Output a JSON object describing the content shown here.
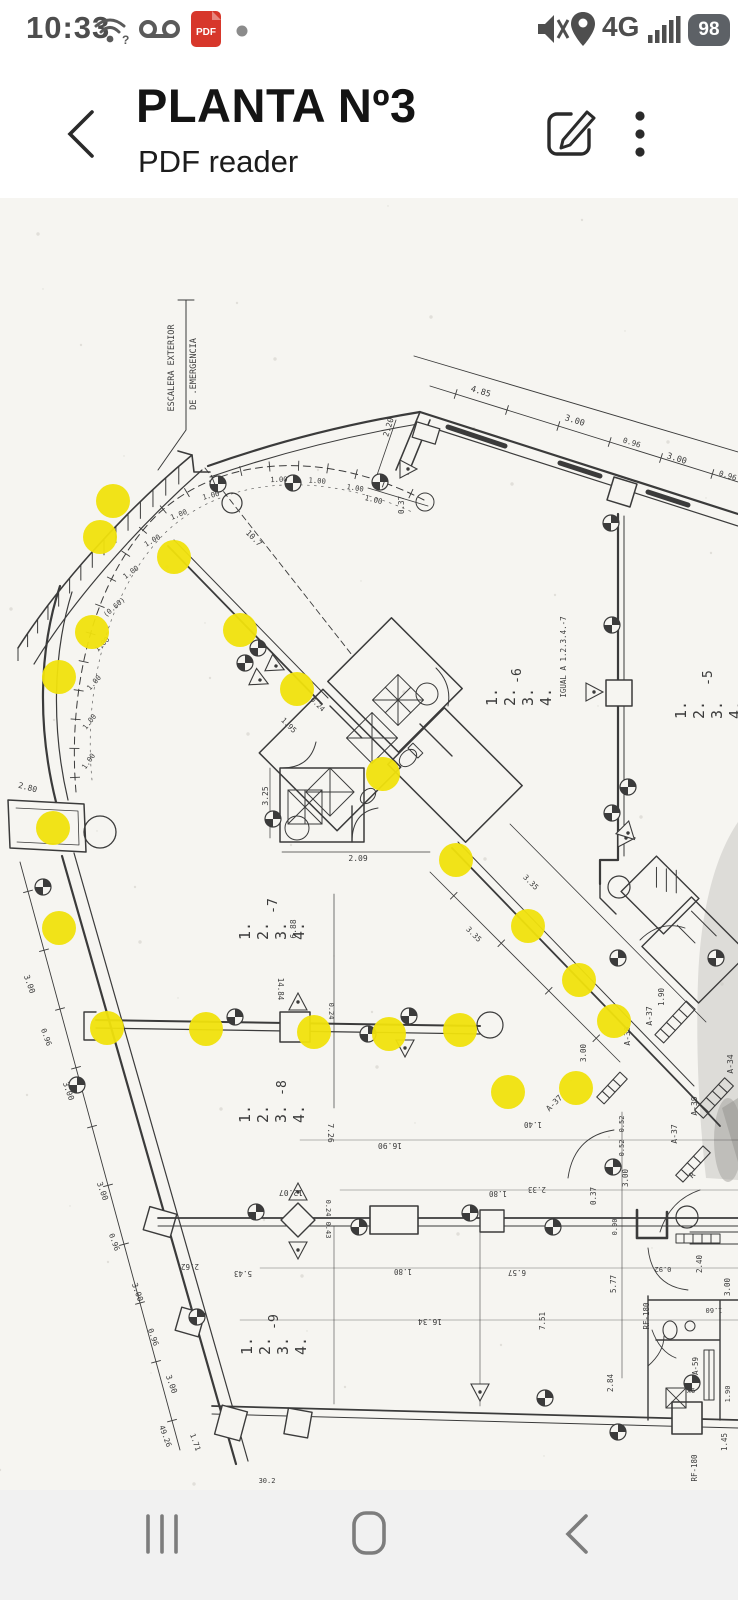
{
  "status_bar": {
    "time": "10:33",
    "pdf_badge": "PDF",
    "network": "4G",
    "battery": "98"
  },
  "header": {
    "title": "PLANTA Nº3",
    "subtitle": "PDF reader"
  },
  "drawing": {
    "paper_color": "#f6f5f1",
    "ink": "#3b3b3b",
    "dot_color": "#f0e20c",
    "stair_note_line1": "ESCALERA  EXTERIOR",
    "stair_note_line2": "DE .EMERGENCIA",
    "room_digits": [
      "1.",
      "2.",
      "3.",
      "4."
    ],
    "rooms": [
      {
        "x": 497,
        "y": 697,
        "sx": 521,
        "sy": 676,
        "suffix": "-6"
      },
      {
        "x": 686,
        "y": 710,
        "sx": 712,
        "sy": 678,
        "suffix": "-5"
      },
      {
        "x": 250,
        "y": 931,
        "sx": 277,
        "sy": 906,
        "suffix": "-7"
      },
      {
        "x": 250,
        "y": 1114,
        "sx": 286,
        "sy": 1088,
        "suffix": "-8"
      },
      {
        "x": 252,
        "y": 1346,
        "sx": 278,
        "sy": 1322,
        "suffix": "-9"
      }
    ],
    "arc_labels": [
      {
        "t": 0.05,
        "text": "1.00"
      },
      {
        "t": 0.12,
        "text": "1.00"
      },
      {
        "t": 0.19,
        "text": "1.00"
      },
      {
        "t": 0.26,
        "text": "1.00"
      },
      {
        "t": 0.33,
        "text": "(0.60)"
      },
      {
        "t": 0.4,
        "text": "1.00"
      },
      {
        "t": 0.47,
        "text": "1.00"
      },
      {
        "t": 0.54,
        "text": "1.00"
      },
      {
        "t": 0.61,
        "text": "1.00"
      },
      {
        "t": 0.74,
        "text": "1.00"
      },
      {
        "t": 0.81,
        "text": "1.00"
      },
      {
        "t": 0.88,
        "text": "1.00"
      }
    ],
    "labels": [
      [
        "10.7",
        252,
        540,
        45,
        8
      ],
      [
        "2.80",
        27,
        790,
        15,
        8
      ],
      [
        "1.00",
        373,
        502,
        14,
        7.5
      ],
      [
        "0.37",
        404,
        505,
        -90,
        7.5
      ],
      [
        "2.20",
        391,
        428,
        -73,
        8
      ],
      [
        "4.85",
        480,
        394,
        17,
        8.5
      ],
      [
        "3.00",
        574,
        423,
        17,
        8.5
      ],
      [
        "0.96",
        631,
        445,
        17,
        7.5
      ],
      [
        "3.00",
        676,
        461,
        17,
        8.5
      ],
      [
        "0.96",
        727,
        478,
        17,
        7.5
      ],
      [
        "1.95",
        287,
        727,
        45,
        7.5
      ],
      [
        "3.25",
        268,
        796,
        -90,
        8
      ],
      [
        "2.09",
        358,
        861,
        0,
        8
      ],
      [
        "6.88",
        296,
        929,
        -90,
        8
      ],
      [
        "14.84",
        278,
        989,
        90,
        7.5
      ],
      [
        "0.24",
        329,
        1011,
        90,
        7
      ],
      [
        "0.24",
        316,
        706,
        45,
        7
      ],
      [
        "IGUAL A 1.2.3.4.-7",
        566,
        657,
        -90,
        7.5
      ],
      [
        "3.35",
        529,
        884,
        45,
        7.5
      ],
      [
        "3.35",
        472,
        936,
        45,
        7.5
      ],
      [
        "3.00",
        586,
        1053,
        -90,
        7.5
      ],
      [
        "1.90",
        664,
        997,
        -90,
        7.5
      ],
      [
        "A-37",
        652,
        1016,
        -90,
        8
      ],
      [
        "A-39",
        630,
        1036,
        -90,
        8
      ],
      [
        "A-34",
        733,
        1064,
        -90,
        8
      ],
      [
        "A-37",
        556,
        1105,
        -45,
        8
      ],
      [
        "A-39",
        697,
        1106,
        -90,
        8
      ],
      [
        "A-37",
        677,
        1134,
        -90,
        8
      ],
      [
        "R",
        694,
        1177,
        -45,
        8
      ],
      [
        "7.26",
        328,
        1133,
        90,
        8
      ],
      [
        "16.90",
        390,
        1143,
        180,
        8
      ],
      [
        "12.07",
        291,
        1190,
        180,
        8
      ],
      [
        "1.80",
        498,
        1191,
        180,
        7.5
      ],
      [
        "2.33",
        537,
        1187,
        180,
        7.5
      ],
      [
        "0.37",
        596,
        1196,
        -90,
        7.5
      ],
      [
        "3.00",
        628,
        1178,
        -90,
        7.5
      ],
      [
        "0.52",
        624,
        1124,
        -90,
        7
      ],
      [
        "0.52",
        624,
        1148,
        -90,
        7
      ],
      [
        "1.40",
        533,
        1122,
        180,
        7.5
      ],
      [
        "0.24",
        326,
        1208,
        90,
        7
      ],
      [
        "0.43",
        326,
        1230,
        90,
        7
      ],
      [
        "1.80",
        403,
        1269,
        180,
        7.5
      ],
      [
        "6.57",
        517,
        1270,
        180,
        7.5
      ],
      [
        "0.90",
        617,
        1227,
        -90,
        7
      ],
      [
        "2.40",
        702,
        1264,
        -90,
        7.5
      ],
      [
        "16.34",
        430,
        1319,
        180,
        8
      ],
      [
        "7.51",
        545,
        1321,
        -90,
        7.5
      ],
      [
        "5.77",
        616,
        1284,
        -90,
        7.5
      ],
      [
        "2.84",
        613,
        1383,
        -90,
        7.5
      ],
      [
        "0.92",
        663,
        1267,
        180,
        7
      ],
      [
        "1.60",
        714,
        1308,
        180,
        7
      ],
      [
        "3.00",
        730,
        1287,
        -90,
        7.5
      ],
      [
        "RF-180",
        649,
        1316,
        -90,
        7.5
      ],
      [
        "A-59",
        698,
        1366,
        -90,
        7.5
      ],
      [
        "x6",
        691,
        1393,
        0,
        7
      ],
      [
        "1.90",
        730,
        1394,
        -90,
        7
      ],
      [
        "1.45",
        727,
        1442,
        -90,
        7.5
      ],
      [
        "RF-180",
        697,
        1468,
        -90,
        7.5
      ],
      [
        "3.00",
        27,
        985,
        70,
        8
      ],
      [
        "0.96",
        44,
        1038,
        70,
        7.5
      ],
      [
        "3.00",
        66,
        1092,
        70,
        8
      ],
      [
        "3.00",
        100,
        1192,
        70,
        8
      ],
      [
        "0.96",
        112,
        1243,
        70,
        7.5
      ],
      [
        "3.00",
        135,
        1293,
        70,
        8
      ],
      [
        "0.96",
        151,
        1338,
        70,
        7.5
      ],
      [
        "3.00",
        169,
        1385,
        70,
        8
      ],
      [
        "49.26",
        163,
        1437,
        70,
        7.5
      ],
      [
        "1.71",
        193,
        1443,
        70,
        7.5
      ],
      [
        "5.43",
        243,
        1271,
        180,
        7.5
      ],
      [
        "2.62",
        190,
        1264,
        180,
        7.5
      ],
      [
        "30.2",
        267,
        1483,
        0,
        7
      ]
    ],
    "dots": [
      [
        113,
        501
      ],
      [
        100,
        537
      ],
      [
        174,
        557
      ],
      [
        92,
        632
      ],
      [
        59,
        677
      ],
      [
        240,
        630
      ],
      [
        297,
        689
      ],
      [
        383,
        774
      ],
      [
        53,
        828
      ],
      [
        59,
        928
      ],
      [
        456,
        860
      ],
      [
        528,
        926
      ],
      [
        579,
        980
      ],
      [
        614,
        1021
      ],
      [
        107,
        1028
      ],
      [
        206,
        1029
      ],
      [
        314,
        1032
      ],
      [
        389,
        1034
      ],
      [
        460,
        1030
      ],
      [
        508,
        1092
      ],
      [
        576,
        1088
      ]
    ]
  }
}
